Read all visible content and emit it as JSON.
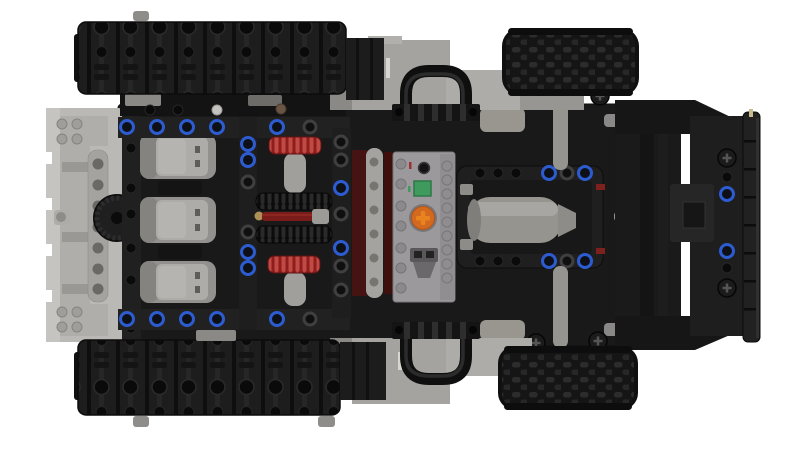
{
  "colors": {
    "background": "#ffffff",
    "track": "#1d1d1d",
    "track_groove": "#0e0e0e",
    "track_hole": "#0a0a0a",
    "tire": "#151515",
    "tire_knob": "#2c2c2c",
    "chassis": "#191919",
    "beam_black": "#212121",
    "panel_black": "#161616",
    "front_black": "#1e1e1e",
    "light_gray": "#bbb9b5",
    "panel_gray": "#a5a3a0",
    "panel_gray_dark": "#8b8985",
    "panel_gray_light": "#aeaca8",
    "mid_gray": "#96948f",
    "motor_body": "#93918d",
    "motor_top": "#aeaca8",
    "motor_vent": "#5f5d59",
    "battery_gray": "#9b999b",
    "connector_gray": "#5a585a",
    "red_gear": "#8e1d1d",
    "red_gear_tooth": "#c14a44",
    "dark_red_panel": "#451311",
    "axle_red": "#7a1d1a",
    "blue_pin": "#2d5bd0",
    "orange_dial": "#d3691e",
    "orange_dial_cross": "#e8831f",
    "green_led": "#3f9a5e",
    "gold_washer": "#ad9055",
    "tan_detail": "#c9b98f",
    "white_slit": "#d8d6d2",
    "stud_gray": "#a09e9a",
    "hole_gray": "#6b6965"
  }
}
